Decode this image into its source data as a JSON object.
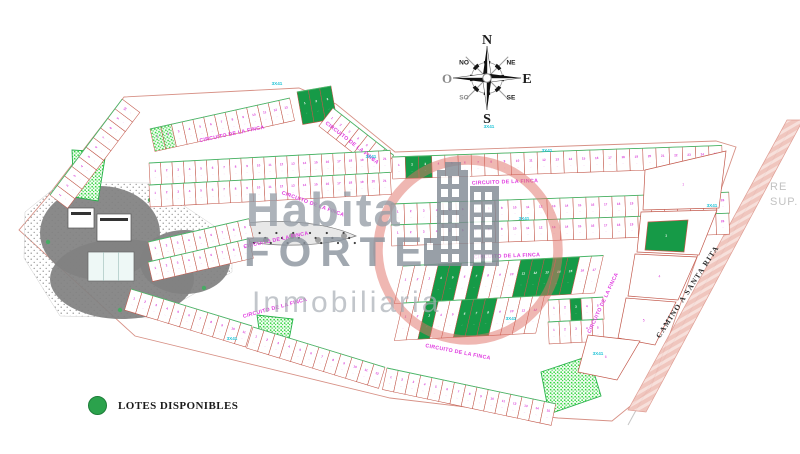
{
  "legend": {
    "label": "LOTES DISPONIBLES",
    "color": "#2ba24c"
  },
  "watermark": {
    "line1": "Habita",
    "line2": "FORTE",
    "line3": "Inmobiliaria",
    "circle_color": "rgba(224,112,102,0.5)",
    "building_color": "#828a94"
  },
  "side_text": {
    "line1": "RE",
    "line2": "SUP."
  },
  "compass": {
    "n": "N",
    "s": "S",
    "e": "E",
    "o": "O",
    "ne": "NE",
    "no": "NO",
    "se": "SE",
    "so": "SO",
    "cx": 487,
    "cy": 78
  },
  "colors": {
    "lotLine": "#c2584b",
    "lotGreen": "#169a47",
    "number": "#d93fd9",
    "numberOnGreen": "#ffffff",
    "street": "#e03ce0",
    "cyan": "#1ec3d6",
    "frontLine": "#49b96b",
    "boundary": "#d79186",
    "outerLine": "#c6c6c6",
    "road": "#efc0b8",
    "blob": "#818181",
    "island": "#e8e8e8"
  },
  "map": {
    "street_name": "CIRCUITO DE LA FINCA",
    "road_name": "CAMINO A SANTA RITA",
    "dim_text": "3X41",
    "boundary_path": "M124,97 L47,197 L19,230 L135,336 L390,398 L558,418 L612,421 L650,390 L736,147 L716,141 L395,152 L336,104 L299,88 Z",
    "outer_line": "M788,132 L628,425",
    "road_poly": [
      [
        787,
        120
      ],
      [
        803,
        120
      ],
      [
        646,
        412
      ],
      [
        628,
        410
      ]
    ],
    "road_label": {
      "x": 688,
      "y": 292,
      "rot": -57
    },
    "street_labels": [
      [
        232,
        134,
        -12
      ],
      [
        352,
        143,
        38
      ],
      [
        505,
        182,
        -2
      ],
      [
        507,
        256,
        -2
      ],
      [
        313,
        204,
        20
      ],
      [
        276,
        240,
        -12
      ],
      [
        275,
        308,
        -15
      ],
      [
        458,
        352,
        11
      ],
      [
        603,
        303,
        -65
      ]
    ],
    "dim_labels": [
      [
        277,
        84
      ],
      [
        371,
        157
      ],
      [
        489,
        127
      ],
      [
        547,
        151
      ],
      [
        524,
        219
      ],
      [
        511,
        319
      ],
      [
        712,
        206
      ],
      [
        598,
        354
      ],
      [
        232,
        339
      ]
    ],
    "rows": [
      {
        "x": 50,
        "y": 195,
        "rot": -53,
        "n": 10,
        "w": 12,
        "d": 22,
        "greens": [],
        "hatch": [],
        "sk": 0
      },
      {
        "x": 150,
        "y": 129,
        "rot": -12.5,
        "n": 13,
        "w": 11,
        "d": 23,
        "greens": [],
        "hatch": [
          0,
          1
        ],
        "sk": 0
      },
      {
        "x": 297,
        "y": 92,
        "rot": -10,
        "n": 3,
        "w": 11.5,
        "d": 33,
        "greens": [
          0,
          1,
          2
        ],
        "hatch": [],
        "sk": 0
      },
      {
        "x": 333,
        "y": 108,
        "rot": 38,
        "n": 7,
        "w": 11,
        "d": 23,
        "greens": [],
        "hatch": [],
        "sk": 0
      },
      {
        "x": 149,
        "y": 163,
        "rot": -3,
        "n": 21,
        "w": 11.5,
        "d": 22,
        "greens": [],
        "hatch": [],
        "sk": 0
      },
      {
        "x": 149,
        "y": 185,
        "rot": -3,
        "n": 21,
        "w": 11.5,
        "d": 22,
        "greens": [],
        "hatch": [],
        "sk": 0
      },
      {
        "x": 148,
        "y": 242,
        "rot": -13,
        "n": 9,
        "w": 11.5,
        "d": 20,
        "greens": [],
        "hatch": [],
        "sk": 0
      },
      {
        "x": 148,
        "y": 262,
        "rot": -13,
        "n": 9,
        "w": 11.5,
        "d": 20,
        "greens": [],
        "hatch": [],
        "sk": 0
      },
      {
        "x": 131,
        "y": 289,
        "rot": 17,
        "n": 11,
        "w": 11.5,
        "d": 22,
        "greens": [],
        "hatch": [],
        "sk": 0
      },
      {
        "x": 253,
        "y": 327,
        "rot": 17,
        "n": 12,
        "w": 11.5,
        "d": 22,
        "greens": [],
        "hatch": [],
        "sk": 0
      },
      {
        "x": 387,
        "y": 368,
        "rot": 12,
        "n": 15,
        "w": 11.5,
        "d": 22,
        "greens": [],
        "hatch": [],
        "sk": 0
      },
      {
        "x": 392,
        "y": 157,
        "rot": -2,
        "n": 25,
        "w": 13.2,
        "d": 22,
        "greens": [
          1,
          2
        ],
        "hatch": [],
        "sk": 0
      },
      {
        "x": 391,
        "y": 204,
        "rot": -2,
        "n": 26,
        "w": 13,
        "d": 21,
        "greens": [],
        "hatch": [],
        "sk": 0
      },
      {
        "x": 391,
        "y": 225,
        "rot": -2,
        "n": 26,
        "w": 13,
        "d": 21,
        "greens": [],
        "hatch": [],
        "sk": 0
      },
      {
        "x": 403,
        "y": 266,
        "rot": -3,
        "n": 17,
        "w": 11.8,
        "d": 37,
        "greens": [
          3,
          4,
          6,
          10,
          11,
          12,
          13,
          14
        ],
        "hatch": [],
        "sk": -16
      },
      {
        "x": 403,
        "y": 303,
        "rot": -3,
        "n": 12,
        "w": 11.8,
        "d": 37,
        "greens": [
          2,
          5,
          6,
          7
        ],
        "hatch": [],
        "sk": -16
      },
      {
        "x": 548,
        "y": 300,
        "rot": -3,
        "n": 5,
        "w": 11,
        "d": 22,
        "greens": [
          2
        ],
        "hatch": [],
        "sk": 0
      },
      {
        "x": 548,
        "y": 322,
        "rot": -3,
        "n": 5,
        "w": 11,
        "d": 22,
        "greens": [],
        "hatch": [],
        "sk": 0
      }
    ],
    "quads": [
      {
        "pts": [
          [
            645,
            170
          ],
          [
            726,
            151
          ],
          [
            719,
            208
          ],
          [
            643,
            210
          ]
        ],
        "green": false
      },
      {
        "pts": [
          [
            641,
            212
          ],
          [
            717,
            210
          ],
          [
            699,
            255
          ],
          [
            637,
            252
          ]
        ],
        "green": false
      },
      {
        "pts": [
          [
            648,
            222
          ],
          [
            688,
            220
          ],
          [
            684,
            252
          ],
          [
            645,
            250
          ]
        ],
        "green": true
      },
      {
        "pts": [
          [
            635,
            254
          ],
          [
            697,
            257
          ],
          [
            678,
            300
          ],
          [
            628,
            296
          ]
        ],
        "green": false
      },
      {
        "pts": [
          [
            626,
            298
          ],
          [
            676,
            302
          ],
          [
            655,
            345
          ],
          [
            618,
            338
          ]
        ],
        "green": false
      },
      {
        "pts": [
          [
            588,
            335
          ],
          [
            640,
            341
          ],
          [
            617,
            380
          ],
          [
            578,
            372
          ]
        ],
        "green": false
      }
    ],
    "parks": [
      {
        "pts": [
          [
            72,
            150
          ],
          [
            106,
            152
          ],
          [
            98,
            201
          ],
          [
            74,
            197
          ]
        ]
      },
      {
        "pts": [
          [
            257,
            315
          ],
          [
            293,
            319
          ],
          [
            288,
            345
          ],
          [
            261,
            343
          ]
        ]
      },
      {
        "pts": [
          [
            541,
            372
          ],
          [
            589,
            356
          ],
          [
            601,
            396
          ],
          [
            549,
            414
          ]
        ]
      }
    ],
    "amenity": {
      "stipple_poly": [
        [
          25,
          212
        ],
        [
          62,
          182
        ],
        [
          150,
          183
        ],
        [
          232,
          238
        ],
        [
          232,
          272
        ],
        [
          152,
          318
        ],
        [
          60,
          316
        ],
        [
          24,
          258
        ]
      ],
      "blobs": [
        {
          "cx": 100,
          "cy": 233,
          "rx": 60,
          "ry": 47
        },
        {
          "cx": 122,
          "cy": 279,
          "rx": 72,
          "ry": 40
        },
        {
          "cx": 185,
          "cy": 262,
          "rx": 45,
          "ry": 32
        }
      ],
      "white_rects": [
        {
          "x": 68,
          "y": 208,
          "w": 26,
          "h": 20
        },
        {
          "x": 97,
          "y": 214,
          "w": 34,
          "h": 27
        }
      ],
      "pool": {
        "x": 88,
        "y": 252,
        "w": 46,
        "h": 29
      },
      "trees": [
        [
          150,
          200
        ],
        [
          163,
          306
        ],
        [
          48,
          242
        ],
        [
          204,
          288
        ],
        [
          232,
          252
        ],
        [
          120,
          310
        ]
      ]
    },
    "island_path": "M216,231 C250,216 320,219 356,236 C322,248 250,250 216,231 Z",
    "building": {
      "t1": {
        "x": 437,
        "y": 170,
        "w": 31,
        "h": 96
      },
      "t2": {
        "x": 470,
        "y": 186,
        "w": 29,
        "h": 80
      },
      "annex": {
        "x": 424,
        "y": 238,
        "w": 13,
        "h": 28
      },
      "cap": {
        "x": 445,
        "y": 162,
        "w": 16,
        "h": 8
      }
    },
    "wm_circle": {
      "cx": 468,
      "cy": 250,
      "r": 90
    }
  }
}
